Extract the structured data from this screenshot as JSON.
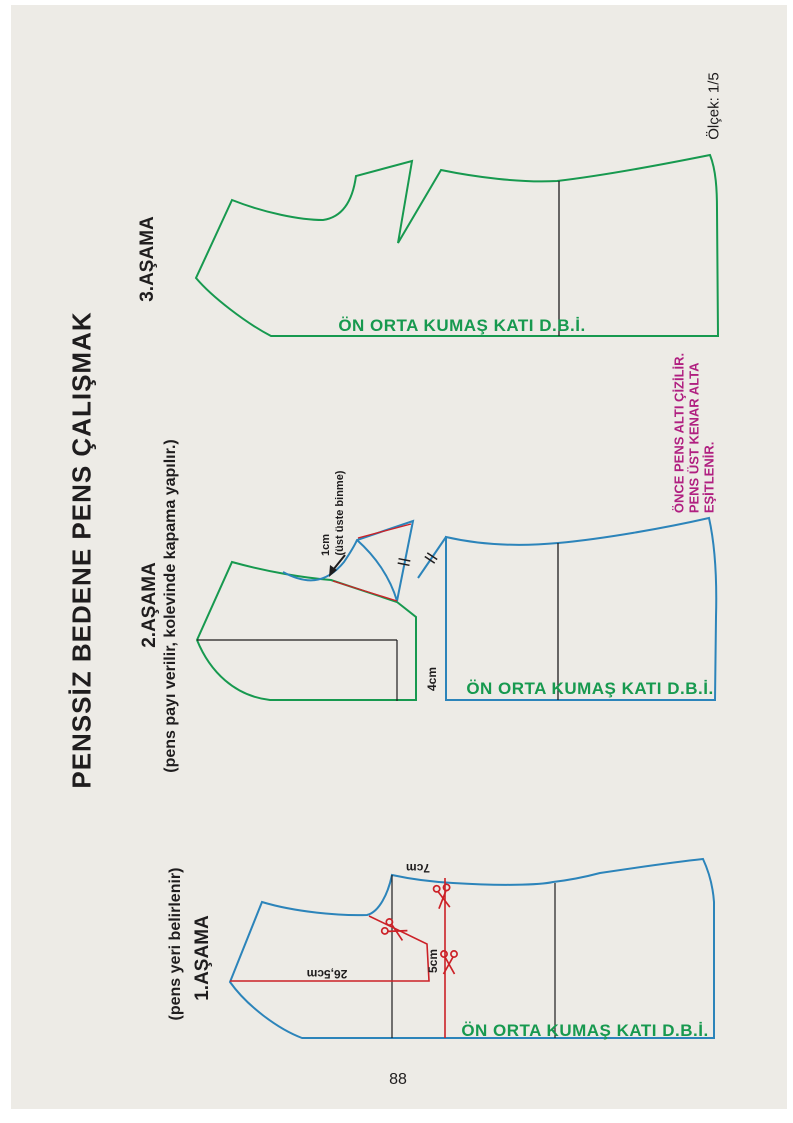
{
  "page": {
    "title": "PENSSİZ BEDENE PENS ÇALIŞMAK",
    "scale_note": "Ölçek: 1/5",
    "page_number": "88",
    "background": "#edebe6",
    "colors": {
      "pattern_green": "#17994f",
      "pattern_blue": "#2c84ba",
      "construction_red": "#cc2127",
      "note_magenta": "#b01f80",
      "line_black": "#1f1d1e"
    }
  },
  "stages": {
    "stage3": {
      "label": "3.AŞAMA",
      "fold_label": "ÖN ORTA KUMAŞ KATI D.B.İ."
    },
    "stage2": {
      "label": "2.AŞAMA",
      "sublabel": "(pens payı verilir, kolevinde kapama yapılır.)",
      "fold_label": "ÖN ORTA KUMAŞ KATI D.B.İ.",
      "overlap_value": "1cm",
      "overlap_note": "(üst üste binme)",
      "gap_label": "4cm",
      "note_line1": "ÖNCE PENS ALTI ÇİZİLİR.",
      "note_line2": "PENS ÜST KENAR ALTA",
      "note_line3": "EŞİTLENİR."
    },
    "stage1": {
      "label": "1.AŞAMA",
      "sublabel": "(pens yeri belirlenir)",
      "fold_label": "ÖN ORTA KUMAŞ KATI D.B.İ.",
      "measure_back": "26,5cm",
      "measure_down": "5cm",
      "measure_top": "7cm"
    }
  }
}
